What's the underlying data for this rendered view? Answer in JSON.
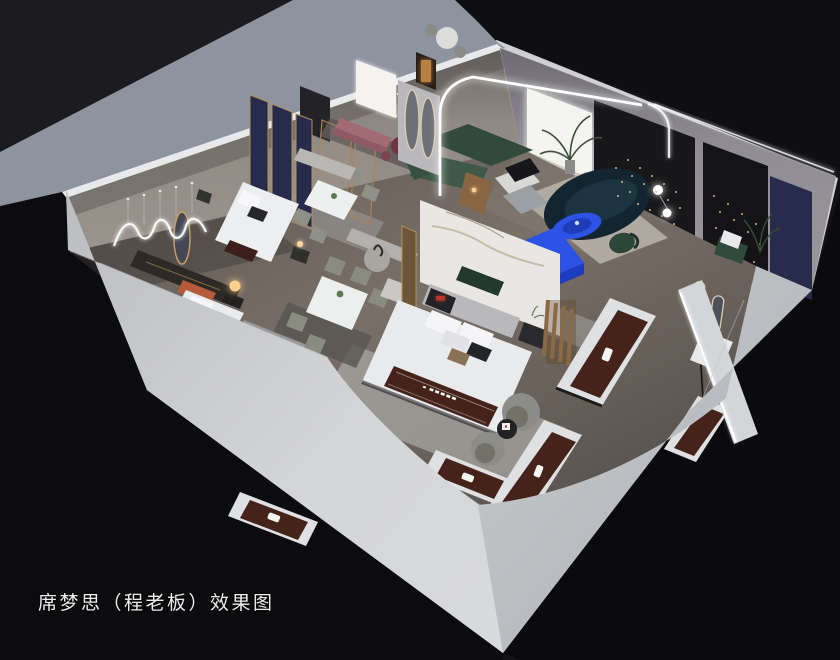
{
  "caption": "席梦思（程老板）效果图",
  "scene": {
    "type": "3d-isometric-interior-render",
    "description": "Cutaway aerial rendering of a Simmons mattress showroom with bedrooms, dining sets, lounge and mattress displays",
    "rooms": [
      "bedroom-top-left",
      "dining-area",
      "lounge",
      "main-bedroom",
      "bedroom-bottom-left",
      "bedroom-right",
      "mattress-display-area"
    ],
    "elements": [
      "exterior-walls",
      "blue-gray-parapet",
      "wood-floor",
      "wavy-neon-wall-light",
      "navy-headboard-panels",
      "bed-one",
      "dining-set-a",
      "dining-set-b",
      "pink-bench",
      "green-sectional-sofa",
      "teal-curved-sofa",
      "blue-coffee-table",
      "blue-tv-console",
      "lounge-window",
      "palm-plant",
      "black-feature-walls",
      "string-lights",
      "navy-wall-panel",
      "green-armchair",
      "arched-led-wall",
      "oval-mirrors",
      "marble-partition",
      "main-bed",
      "brand-runner",
      "smart-nightstand",
      "bed-terracotta",
      "table-lamp",
      "mattress-displays",
      "barrel-chairs",
      "round-side-table",
      "stone-platforms",
      "arch-mirrors",
      "crystal-pendant",
      "floor-lamp-globes"
    ]
  },
  "palette": {
    "background": "#131316",
    "background_top": "#1c1c1f",
    "background_bottom": "#0c0c0e",
    "wall_light": "#d2d3d6",
    "wall_mid": "#bfc0c5",
    "wall_blue_gray": "#8e93a0",
    "wall_top_edge": "#e8e9eb",
    "interior_wall": "#8d8781",
    "floor_mid": "#6f6760",
    "floor_dark": "#4c4742",
    "ceiling_dark": "#0f0f12",
    "feature_black": "#17171a",
    "panel_navy": "#272c4c",
    "marble_white": "#e9e7e3",
    "accent_blue": "#2d52e6",
    "accent_blue_deep": "#1e3cc0",
    "sofa_green": "#3f5847",
    "sofa_teal": "#132530",
    "bench_pink": "#a26a73",
    "runner_brown": "#45231b",
    "terracotta": "#b65a3c",
    "gold": "#b28e5c",
    "lamp_warm": "#ffc97e",
    "bedding_white": "#e9eaec",
    "rug_light": "#a8a5a2",
    "led_white": "#ffffff"
  }
}
